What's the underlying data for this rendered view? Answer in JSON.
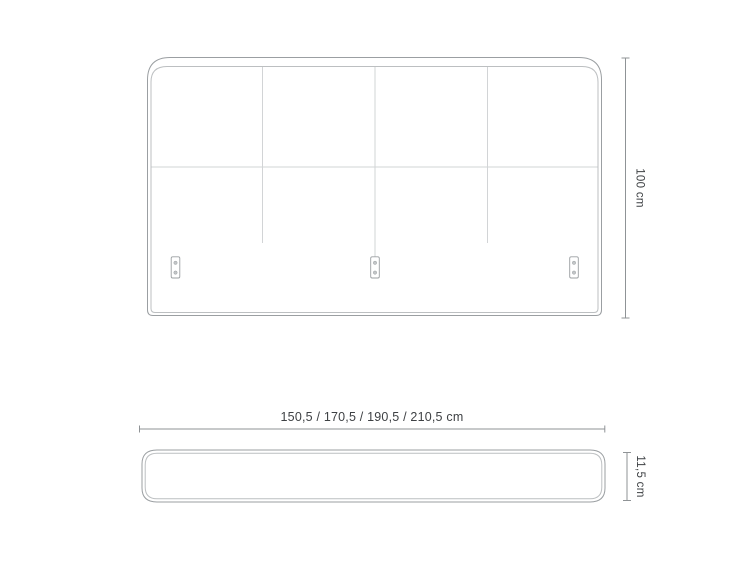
{
  "page": {
    "background": "#ffffff"
  },
  "labels": {
    "height": "100 cm",
    "width_variants": "150,5 / 170,5 / 190,5 / 210,5 cm",
    "thickness": "11,5 cm"
  },
  "front_view": {
    "panels": 4,
    "vertical_seams": 3,
    "horizontal_seams": 1,
    "mounting_brackets": 3,
    "screw_holes_per_bracket": 2
  },
  "colors": {
    "outline": "#9b9fa2",
    "inner_edge": "#bcbfc1",
    "seam": "#d2d4d6",
    "bracket_fill": "#ffffff",
    "screw_hole": "#c3c6c8",
    "dimension": "#8f9396",
    "text": "#3e4144",
    "background": "#ffffff"
  }
}
